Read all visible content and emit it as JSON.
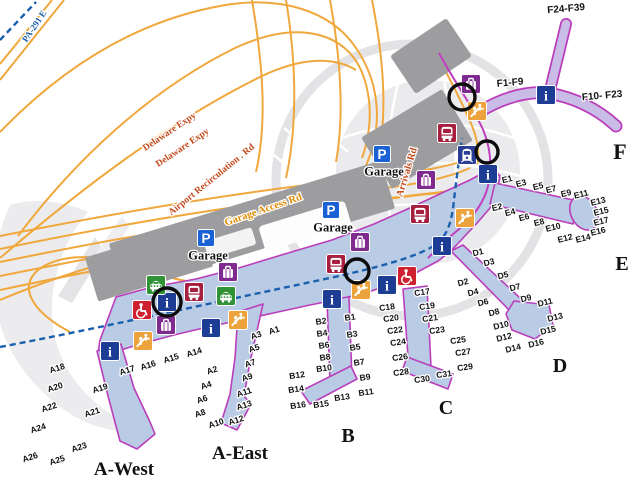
{
  "colors": {
    "highway_orange": "#F0A73C",
    "garage_access_label": "#E08A00",
    "road_label_red": "#C2491C",
    "route_sign_blue": "#1A5CA8",
    "rail_dash_blue": "#1B5FAF",
    "arrivals_road_magenta": "#C03FC0",
    "concourse_fill": "#B9CBE5",
    "concourse_stroke": "#BB3DBB",
    "f_concourse_fill": "#C9BCE6",
    "building_gray": "#9D9DA0",
    "watermark_gray": "#EBEBED",
    "annotation_black": "#0B0B0B",
    "icon_info": "#1D3C94",
    "icon_parking": "#1B61D6",
    "icon_bus": "#A81E3E",
    "icon_taxi": "#2F9235",
    "icon_baggage": "#7E2A8E",
    "icon_accessibility": "#CF2030",
    "icon_escalator": "#ECA33C",
    "icon_train": "#2B3C97"
  },
  "region_labels": [
    {
      "text": "A-West",
      "x": 124,
      "y": 468,
      "size": 19
    },
    {
      "text": "A-East",
      "x": 240,
      "y": 452,
      "size": 19
    },
    {
      "text": "B",
      "x": 348,
      "y": 435,
      "size": 20
    },
    {
      "text": "C",
      "x": 446,
      "y": 407,
      "size": 20
    },
    {
      "text": "D",
      "x": 560,
      "y": 365,
      "size": 20
    },
    {
      "text": "E",
      "x": 622,
      "y": 263,
      "size": 20
    },
    {
      "text": "F",
      "x": 620,
      "y": 151,
      "size": 22
    }
  ],
  "road_labels": [
    {
      "text": "PA-291 E",
      "x": 34,
      "y": 26,
      "rot": -56,
      "color": "#1A5CA8",
      "size": 9
    },
    {
      "text": "Delaware Expy",
      "x": 169,
      "y": 131,
      "rot": -34,
      "color": "#C2491C",
      "size": 9.5
    },
    {
      "text": "Delaware Expy",
      "x": 182,
      "y": 147,
      "rot": -34,
      "color": "#C2491C",
      "size": 9.5
    },
    {
      "text": "Airport Recirculation . Rd",
      "x": 211,
      "y": 179,
      "rot": -39,
      "color": "#C2491C",
      "size": 9.5
    },
    {
      "text": "Garage Access Rd",
      "x": 263,
      "y": 209,
      "rot": -19,
      "color": "#E08A00",
      "size": 10.5
    },
    {
      "text": "Arrivals Rd",
      "x": 406,
      "y": 172,
      "rot": -73,
      "color": "#C2491C",
      "size": 10
    }
  ],
  "garage": {
    "label": "Garage",
    "glyph": "P",
    "locations": [
      {
        "x": 206,
        "y": 238
      },
      {
        "x": 331,
        "y": 210
      },
      {
        "x": 382,
        "y": 154
      }
    ]
  },
  "icons": [
    {
      "type": "info",
      "glyph": "i",
      "color": "#1D3C94",
      "positions": [
        [
          546,
          95
        ],
        [
          488,
          174
        ],
        [
          442,
          246
        ],
        [
          387,
          285
        ],
        [
          332,
          299
        ],
        [
          211,
          328
        ],
        [
          110,
          351
        ],
        [
          167,
          302
        ]
      ]
    },
    {
      "type": "train-station",
      "color": "#2B3C97",
      "positions": [
        [
          467,
          155
        ]
      ]
    },
    {
      "type": "bus",
      "color": "#A81E3E",
      "positions": [
        [
          447,
          133
        ],
        [
          420,
          214
        ],
        [
          336,
          264
        ],
        [
          194,
          292
        ]
      ]
    },
    {
      "type": "taxi",
      "color": "#2F9235",
      "positions": [
        [
          156,
          285
        ],
        [
          226,
          296
        ]
      ]
    },
    {
      "type": "baggage-claim",
      "color": "#7E2A8E",
      "positions": [
        [
          471,
          84
        ],
        [
          426,
          180
        ],
        [
          360,
          242
        ],
        [
          228,
          272
        ],
        [
          166,
          325
        ]
      ]
    },
    {
      "type": "accessibility",
      "color": "#CF2030",
      "positions": [
        [
          142,
          310
        ],
        [
          407,
          276
        ]
      ]
    },
    {
      "type": "escalator",
      "color": "#ECA33C",
      "positions": [
        [
          477,
          111
        ],
        [
          465,
          218
        ],
        [
          361,
          290
        ],
        [
          238,
          320
        ],
        [
          143,
          341
        ]
      ]
    }
  ],
  "annotation_circles": [
    {
      "x": 462,
      "y": 97,
      "r": 13
    },
    {
      "x": 487,
      "y": 152,
      "r": 11
    },
    {
      "x": 357,
      "y": 271,
      "r": 12
    },
    {
      "x": 167,
      "y": 302,
      "r": 14
    }
  ],
  "gates": [
    {
      "concourse": "A",
      "rot": -18,
      "size": 8.6,
      "labels": [
        {
          "t": "A1",
          "x": 274,
          "y": 330
        },
        {
          "t": "A2",
          "x": 212,
          "y": 370
        },
        {
          "t": "A3",
          "x": 256,
          "y": 335
        },
        {
          "t": "A4",
          "x": 206,
          "y": 385
        },
        {
          "t": "A5",
          "x": 254,
          "y": 348
        },
        {
          "t": "A6",
          "x": 202,
          "y": 399
        },
        {
          "t": "A7",
          "x": 250,
          "y": 363
        },
        {
          "t": "A8",
          "x": 200,
          "y": 413
        },
        {
          "t": "A9",
          "x": 247,
          "y": 377
        },
        {
          "t": "A10",
          "x": 216,
          "y": 423
        },
        {
          "t": "A11",
          "x": 244,
          "y": 392
        },
        {
          "t": "A12",
          "x": 236,
          "y": 420
        },
        {
          "t": "A13",
          "x": 244,
          "y": 405
        },
        {
          "t": "A14",
          "x": 194,
          "y": 352
        },
        {
          "t": "A15",
          "x": 171,
          "y": 358
        },
        {
          "t": "A16",
          "x": 148,
          "y": 365
        },
        {
          "t": "A17",
          "x": 127,
          "y": 370
        },
        {
          "t": "A18",
          "x": 57,
          "y": 368
        },
        {
          "t": "A19",
          "x": 100,
          "y": 388
        },
        {
          "t": "A20",
          "x": 55,
          "y": 387
        },
        {
          "t": "A21",
          "x": 92,
          "y": 412
        },
        {
          "t": "A22",
          "x": 49,
          "y": 407
        },
        {
          "t": "A23",
          "x": 79,
          "y": 447
        },
        {
          "t": "A24",
          "x": 38,
          "y": 428
        },
        {
          "t": "A25",
          "x": 57,
          "y": 460
        },
        {
          "t": "A26",
          "x": 30,
          "y": 457
        }
      ]
    },
    {
      "concourse": "B",
      "rot": -8,
      "size": 8.6,
      "labels": [
        {
          "t": "B1",
          "x": 350,
          "y": 317
        },
        {
          "t": "B2",
          "x": 321,
          "y": 321
        },
        {
          "t": "B3",
          "x": 352,
          "y": 334
        },
        {
          "t": "B4",
          "x": 322,
          "y": 333
        },
        {
          "t": "B5",
          "x": 355,
          "y": 347
        },
        {
          "t": "B6",
          "x": 324,
          "y": 345
        },
        {
          "t": "B7",
          "x": 359,
          "y": 362
        },
        {
          "t": "B8",
          "x": 325,
          "y": 357
        },
        {
          "t": "B9",
          "x": 365,
          "y": 377
        },
        {
          "t": "B10",
          "x": 324,
          "y": 368
        },
        {
          "t": "B11",
          "x": 366,
          "y": 392
        },
        {
          "t": "B12",
          "x": 297,
          "y": 375
        },
        {
          "t": "B13",
          "x": 342,
          "y": 397
        },
        {
          "t": "B14",
          "x": 296,
          "y": 389
        },
        {
          "t": "B15",
          "x": 321,
          "y": 404
        },
        {
          "t": "B16",
          "x": 298,
          "y": 405
        }
      ]
    },
    {
      "concourse": "C",
      "rot": -8,
      "size": 8.6,
      "labels": [
        {
          "t": "C17",
          "x": 422,
          "y": 292
        },
        {
          "t": "C18",
          "x": 387,
          "y": 307
        },
        {
          "t": "C19",
          "x": 427,
          "y": 306
        },
        {
          "t": "C20",
          "x": 391,
          "y": 318
        },
        {
          "t": "C21",
          "x": 430,
          "y": 318
        },
        {
          "t": "C22",
          "x": 395,
          "y": 330
        },
        {
          "t": "C23",
          "x": 437,
          "y": 330
        },
        {
          "t": "C24",
          "x": 398,
          "y": 342
        },
        {
          "t": "C25",
          "x": 458,
          "y": 340
        },
        {
          "t": "C26",
          "x": 400,
          "y": 357
        },
        {
          "t": "C27",
          "x": 463,
          "y": 352
        },
        {
          "t": "C28",
          "x": 401,
          "y": 372
        },
        {
          "t": "C29",
          "x": 465,
          "y": 367
        },
        {
          "t": "C30",
          "x": 422,
          "y": 379
        },
        {
          "t": "C31",
          "x": 444,
          "y": 374
        }
      ]
    },
    {
      "concourse": "D",
      "rot": -14,
      "size": 8.6,
      "labels": [
        {
          "t": "D1",
          "x": 478,
          "y": 252
        },
        {
          "t": "D2",
          "x": 463,
          "y": 282
        },
        {
          "t": "D3",
          "x": 489,
          "y": 262
        },
        {
          "t": "D4",
          "x": 473,
          "y": 292
        },
        {
          "t": "D5",
          "x": 503,
          "y": 275
        },
        {
          "t": "D6",
          "x": 483,
          "y": 302
        },
        {
          "t": "D7",
          "x": 515,
          "y": 287
        },
        {
          "t": "D8",
          "x": 494,
          "y": 312
        },
        {
          "t": "D9",
          "x": 526,
          "y": 298
        },
        {
          "t": "D10",
          "x": 501,
          "y": 325
        },
        {
          "t": "D11",
          "x": 545,
          "y": 302
        },
        {
          "t": "D12",
          "x": 504,
          "y": 337
        },
        {
          "t": "D13",
          "x": 555,
          "y": 317
        },
        {
          "t": "D14",
          "x": 513,
          "y": 348
        },
        {
          "t": "D15",
          "x": 548,
          "y": 330
        },
        {
          "t": "D16",
          "x": 536,
          "y": 343
        }
      ]
    },
    {
      "concourse": "E",
      "rot": -14,
      "size": 8.6,
      "labels": [
        {
          "t": "E1",
          "x": 507,
          "y": 179
        },
        {
          "t": "E2",
          "x": 497,
          "y": 207
        },
        {
          "t": "E3",
          "x": 521,
          "y": 183
        },
        {
          "t": "E4",
          "x": 510,
          "y": 212
        },
        {
          "t": "E5",
          "x": 538,
          "y": 186
        },
        {
          "t": "E6",
          "x": 524,
          "y": 217
        },
        {
          "t": "E7",
          "x": 551,
          "y": 189
        },
        {
          "t": "E8",
          "x": 539,
          "y": 222
        },
        {
          "t": "E9",
          "x": 566,
          "y": 193
        },
        {
          "t": "E10",
          "x": 553,
          "y": 227
        },
        {
          "t": "E11",
          "x": 581,
          "y": 194
        },
        {
          "t": "E12",
          "x": 565,
          "y": 238
        },
        {
          "t": "E13",
          "x": 598,
          "y": 201
        },
        {
          "t": "E14",
          "x": 583,
          "y": 238
        },
        {
          "t": "E15",
          "x": 601,
          "y": 211
        },
        {
          "t": "E16",
          "x": 598,
          "y": 231
        },
        {
          "t": "E17",
          "x": 601,
          "y": 221
        }
      ]
    },
    {
      "concourse": "F",
      "rot": -5,
      "size": 10,
      "labels": [
        {
          "t": "F1-F9",
          "x": 510,
          "y": 82
        },
        {
          "t": "F10- F23",
          "x": 602,
          "y": 95
        },
        {
          "t": "F24-F39",
          "x": 566,
          "y": 8
        }
      ]
    }
  ]
}
